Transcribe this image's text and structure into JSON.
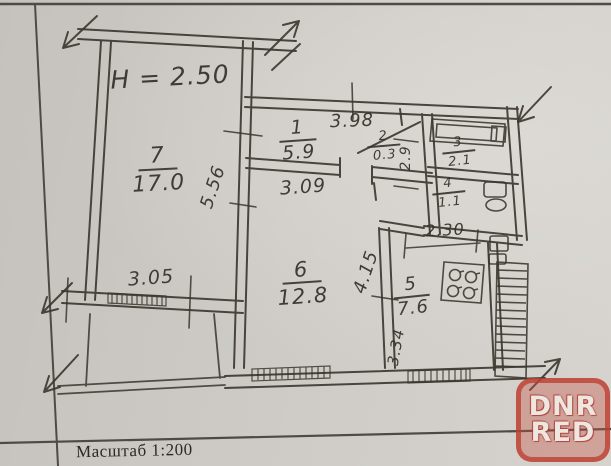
{
  "footer": {
    "scale_label": "Масштаб 1:200"
  },
  "plan": {
    "height_note": "H = 2.50",
    "rooms": {
      "r1": {
        "number": "1",
        "area": "5.9"
      },
      "r2": {
        "number": "2",
        "area": "0.3"
      },
      "r3": {
        "number": "3",
        "area": "2.1"
      },
      "r4": {
        "number": "4",
        "area": "1.1"
      },
      "r5": {
        "number": "5",
        "area": "7.6"
      },
      "r6": {
        "number": "6",
        "area": "12.8"
      },
      "r7": {
        "number": "7",
        "area": "17.0"
      }
    },
    "dimensions": {
      "corridor_length": "3.98",
      "room6_width": "3.09",
      "room7_depth": "5.56",
      "room7_width": "3.05",
      "room6_depth": "4.15",
      "kitchen_depth": "3.34",
      "sanitary_width": "2.30",
      "hall_depth": "2.9"
    }
  },
  "watermark": {
    "line1": "DNR",
    "line2": "RED",
    "color": "#bc3e30"
  }
}
